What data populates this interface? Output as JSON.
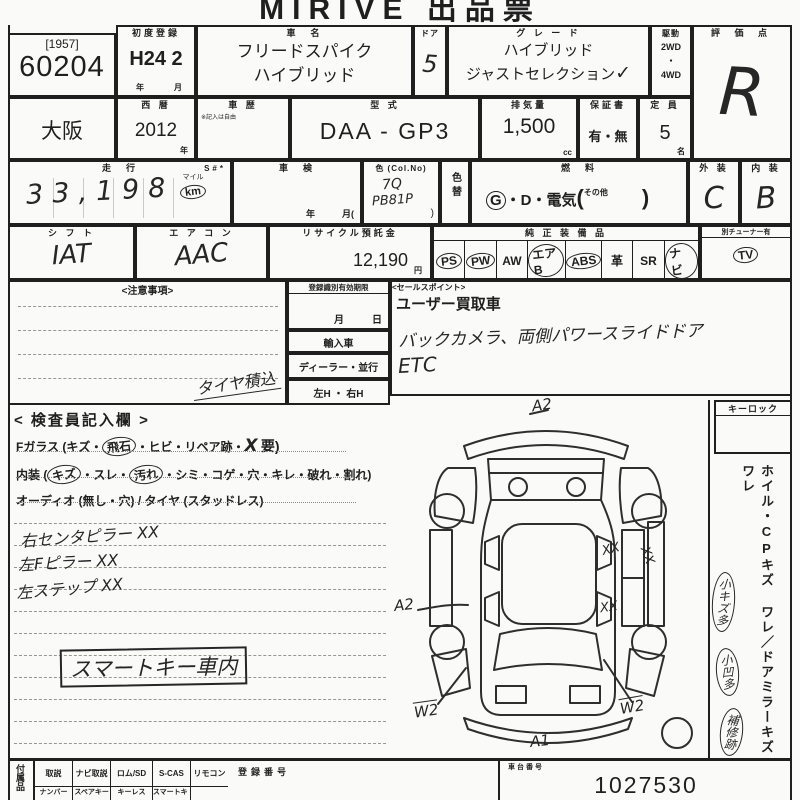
{
  "title": "MIRIVE 出品票",
  "colors": {
    "paper": "#fafaf8",
    "ink": "#1f1f1f",
    "hand": "#262626"
  },
  "header": {
    "lot_ref": "[1957]",
    "lot_no": "60204",
    "first_reg_label": "初度登録",
    "first_reg_value": "H24 2",
    "year_unit": "年",
    "month_unit": "月",
    "car_name_label": "車　名",
    "car_name_line1": "フリードスパイク",
    "car_name_line2": "ハイブリッド",
    "door_label": "ドア",
    "door_value": "5",
    "grade_label": "グ レ ー ド",
    "grade_line1": "ハイブリッド",
    "grade_line2": "ジャストセレクション",
    "grade_check": "✓",
    "drive_label": "駆動",
    "drive_2wd": "2WD",
    "drive_sep": "・",
    "drive_4wd": "4WD",
    "score_label": "評 価 点",
    "score_value": "R"
  },
  "row2": {
    "prefecture": "大阪",
    "west_label": "西 暦",
    "west_value": "2012",
    "west_unit": "年",
    "history_label": "車 歴",
    "history_note": "※記入は自由",
    "model_label": "型 式",
    "model_value": "DAA - GP3",
    "disp_label": "排気量",
    "disp_value": "1,500",
    "disp_unit": "cc",
    "warranty_label": "保証書",
    "warranty_value": "有・無",
    "capacity_label": "定 員",
    "capacity_value": "5",
    "capacity_unit": "名"
  },
  "row3": {
    "mileage_label": "走　行",
    "s_label": "S#*",
    "mileage_value": "33,198",
    "mileage_mile": "マイル",
    "mileage_unit": "km",
    "shaken_label": "車　検",
    "shaken_units": "年　　　月(",
    "color_label": "色 (Col.No)",
    "color_code": "7Q",
    "color_no": "PB81P",
    "color_paren": ")",
    "color_change_label": "色替",
    "fuel_label": "燃　料",
    "fuel_g": "G",
    "fuel_rest": "・D・電気",
    "fuel_open": "(",
    "fuel_other": "その他",
    "fuel_close": ")",
    "exterior_label": "外 装",
    "exterior_value": "C",
    "interior_label": "内 装",
    "interior_value": "B"
  },
  "row4": {
    "shift_label": "シ フ ト",
    "shift_value": "IAT",
    "aircon_label": "エ ア コ ン",
    "aircon_value": "AAC",
    "recycle_label": "リサイクル預託金",
    "recycle_value": "12,190",
    "recycle_unit": "円",
    "equip_label": "純 正 装 備 品",
    "equipment": [
      {
        "code": "PS",
        "circled": true
      },
      {
        "code": "PW",
        "circled": true
      },
      {
        "code": "AW",
        "circled": false
      },
      {
        "code": "エアB",
        "circled": true
      },
      {
        "code": "ABS",
        "circled": true
      },
      {
        "code": "革",
        "circled": false
      },
      {
        "code": "SR",
        "circled": false
      },
      {
        "code": "ナビ",
        "circled": true
      }
    ],
    "tv_header": "別チューナー有",
    "tv_code": "TV",
    "tv_circled": true
  },
  "notes": {
    "caution_label": "<注意事項>",
    "hand_note": "タイヤ積込",
    "reg_label": "登録識別有効期限",
    "reg_month": "月",
    "reg_day": "日",
    "import_label": "輸入車",
    "dealer_label": "ディーラー・並行",
    "handle_label": "左H ・ 右H",
    "sales_label": "<セールスポイント>",
    "sales_printed": "ユーザー買取車",
    "sales_hand1": "バックカメラ、両側パワースライドドア",
    "sales_hand2": "ETC"
  },
  "inspector": {
    "section_label": "< 検査員記入欄 >",
    "fglass": [
      {
        "t": "Fガラス (キズ・"
      },
      {
        "t": "飛石",
        "circled": true
      },
      {
        "t": "・ヒビ・リペア跡・"
      },
      {
        "t": "X",
        "hand": true
      },
      {
        "t": "要)"
      }
    ],
    "naiso": [
      {
        "t": "内装 ("
      },
      {
        "t": "キズ",
        "circled": true
      },
      {
        "t": "・スレ・"
      },
      {
        "t": "汚れ",
        "circled": true
      },
      {
        "t": "・シミ・コゲ・穴・キレ・破れ・割れ)"
      }
    ],
    "audio_line": "オーディオ (無し・穴) / タイヤ (スタッドレス)",
    "hand_notes": [
      "右センタピラー XX",
      "左Fピラー XX",
      "左ステップ XX"
    ],
    "smart_key": "スマートキー車内"
  },
  "diagram": {
    "rear_label": "A2",
    "side_label": "A2",
    "front_label": "A1",
    "wheel_left_label": "W2",
    "wheel_right_label": "W2",
    "marks": [
      "XX",
      "XX",
      "XX"
    ]
  },
  "sidebar": {
    "keylock": "キーロック",
    "damage_line": "ホイル・CPキズ ワレ／ドアミラーキズ ワレ",
    "circled": [
      "小キズ多",
      "小凹多",
      "補修跡"
    ]
  },
  "footer": {
    "acc_label": "付属品",
    "row1": [
      "取説",
      "ナビ取説",
      "ロム/SD",
      "S-CAS",
      "リモコン"
    ],
    "row2": [
      "ナンバー",
      "スペアキー",
      "キーレス",
      "スマートキー"
    ],
    "reg_label": "登録番号",
    "chassis_label": "車台番号",
    "chassis_value": "1027530"
  }
}
